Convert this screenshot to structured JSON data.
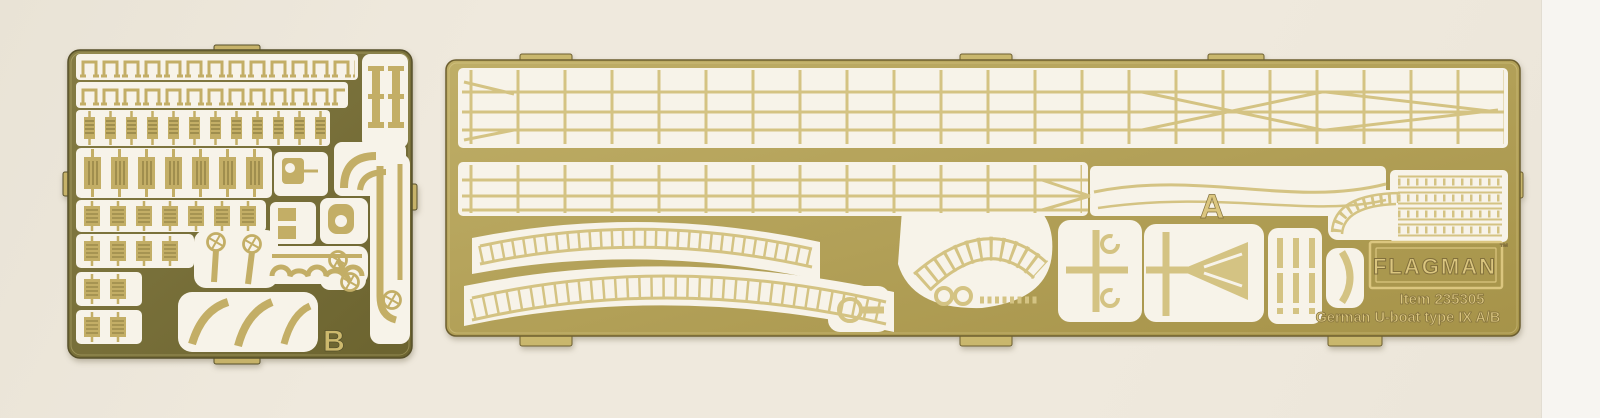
{
  "fret_b": {
    "label": "B"
  },
  "fret_a": {
    "label": "A",
    "branding": {
      "logo": "FLAGMAN",
      "trademark": "™",
      "item": "Item 235305",
      "product": "German U-boat type IX A/B"
    }
  },
  "colors": {
    "bg": "#efe9dd",
    "bg-edge": "#f7f5f1",
    "cutout": "#f7f3e9",
    "plate-b1": "#857c44",
    "plate-b2": "#6b632f",
    "part-b": "#c3ae66",
    "part-b-dark": "#8a7a3f",
    "tab-b": "#c6b269",
    "label-b": "#cdb96d",
    "plate-a1": "#bfae67",
    "plate-a2": "#a69349",
    "part-a": "#d4c383",
    "tab-a": "#c9b76d",
    "etch-light": "#dbc67f",
    "etch-dark": "#82703c"
  }
}
